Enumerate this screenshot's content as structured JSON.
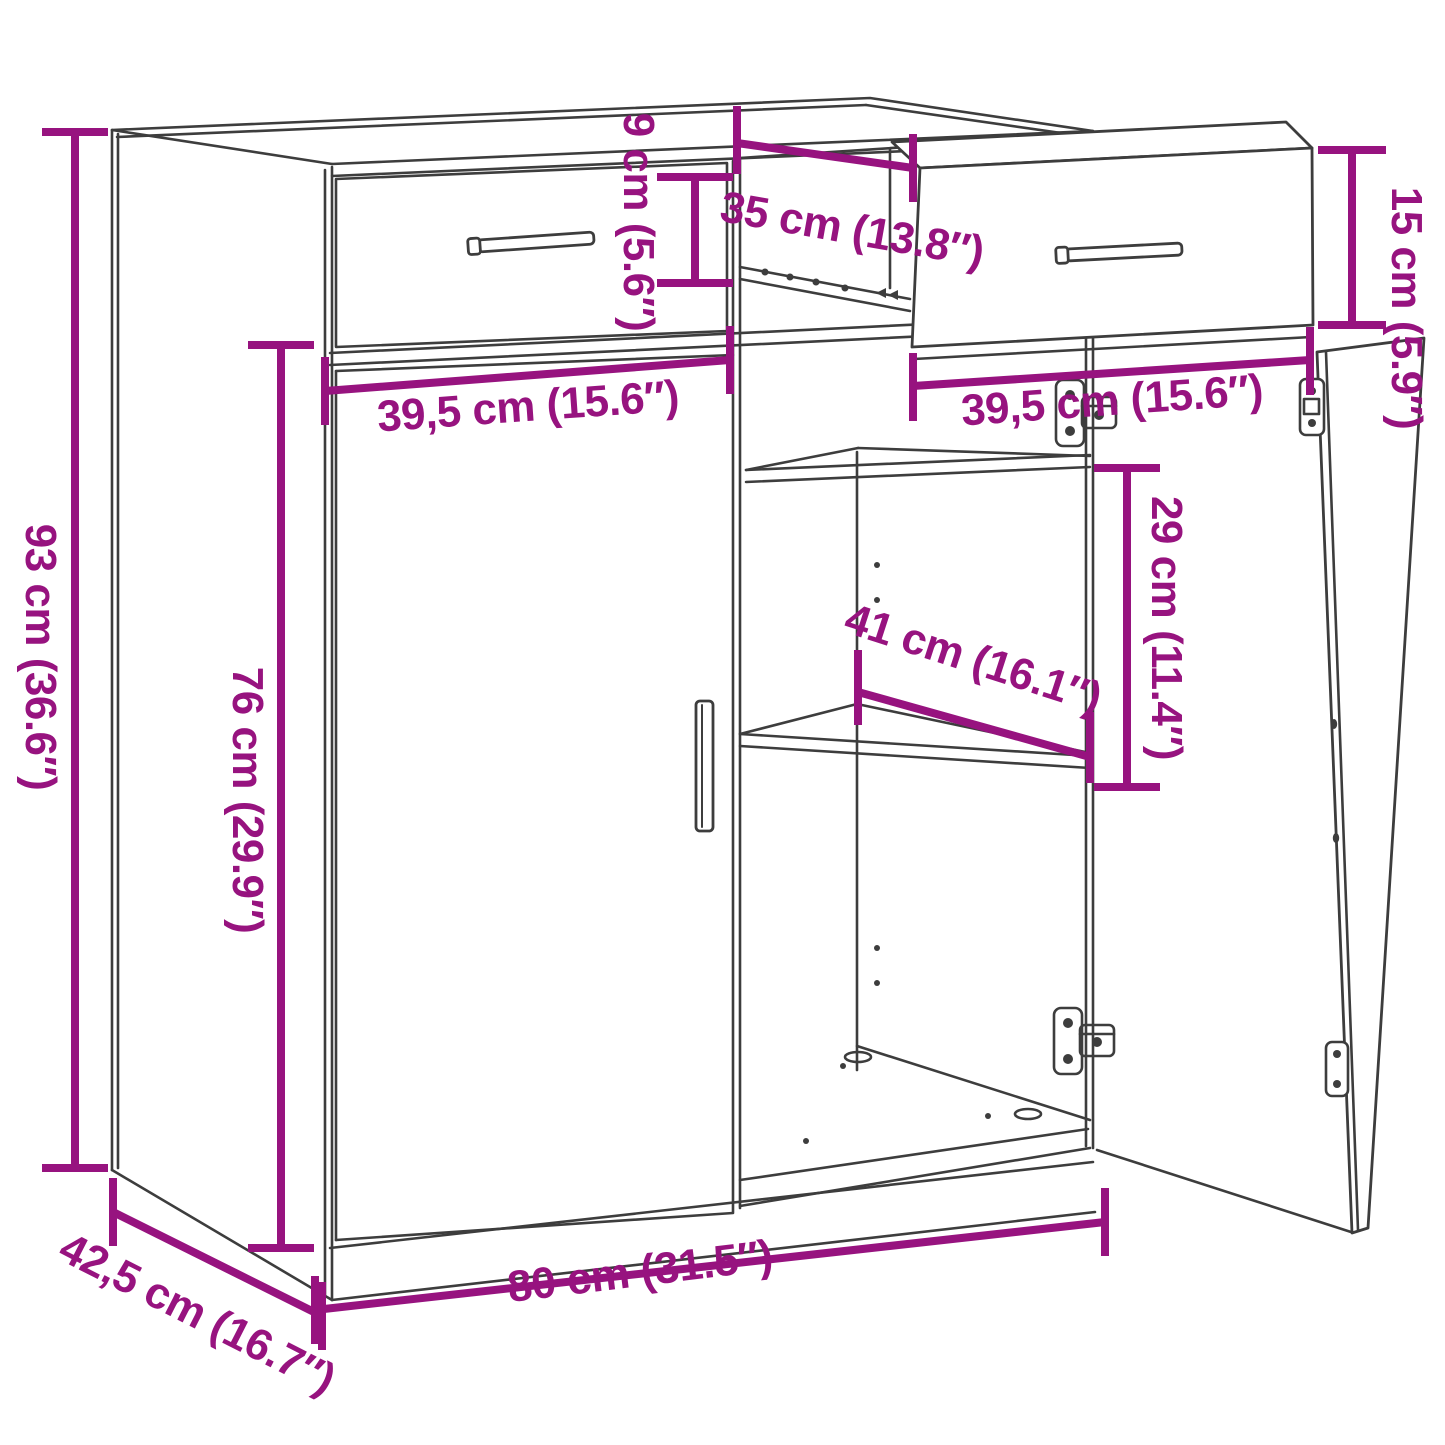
{
  "canvas": {
    "width": 1445,
    "height": 1445,
    "background": "#ffffff"
  },
  "colors": {
    "dimension": "#97137f",
    "outline": "#3d3d3d"
  },
  "diagram": {
    "type": "product-dimension-line-drawing",
    "subject": "Sideboard cabinet with two drawers (right drawer pulled out) and two doors (right door open) showing interior shelves",
    "dimensions": [
      {
        "id": "overall-height",
        "label": "93 cm (36.6″)",
        "value_cm": "93",
        "value_in": "36.6"
      },
      {
        "id": "door-section-height",
        "label": "76 cm (29.9″)",
        "value_cm": "76",
        "value_in": "29.9"
      },
      {
        "id": "drawer-inner-height",
        "label": "9 cm (5.6″)",
        "value_cm": "9",
        "value_in": "5.6"
      },
      {
        "id": "drawer-depth",
        "label": "35 cm (13.8″)",
        "value_cm": "35",
        "value_in": "13.8"
      },
      {
        "id": "drawer-front-height",
        "label": "15 cm (5.9″)",
        "value_cm": "15",
        "value_in": "5.9"
      },
      {
        "id": "left-drawer-width",
        "label": "39,5 cm (15.6″)",
        "value_cm": "39,5",
        "value_in": "15.6"
      },
      {
        "id": "right-drawer-width",
        "label": "39,5 cm (15.6″)",
        "value_cm": "39,5",
        "value_in": "15.6"
      },
      {
        "id": "shelf-gap-height",
        "label": "29 cm (11.4″)",
        "value_cm": "29",
        "value_in": "11.4"
      },
      {
        "id": "shelf-depth",
        "label": "41 cm (16.1″)",
        "value_cm": "41",
        "value_in": "16.1"
      },
      {
        "id": "overall-width",
        "label": "80 cm (31.5″)",
        "value_cm": "80",
        "value_in": "31.5"
      },
      {
        "id": "overall-depth",
        "label": "42,5 cm (16.7″)",
        "value_cm": "42,5",
        "value_in": "16.7"
      }
    ]
  }
}
